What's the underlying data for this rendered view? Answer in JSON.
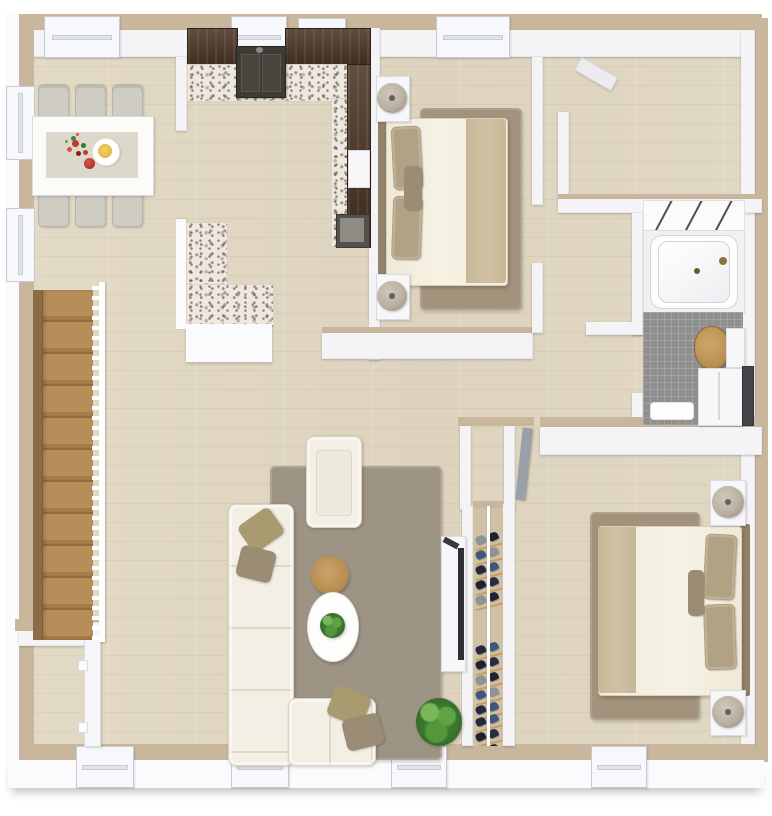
{
  "scene": {
    "type": "3d-floorplan-top-down-render",
    "description": "Two-bedroom apartment 3D floor plan viewed from above; no text labels are rendered in the image"
  },
  "colors": {
    "wall-top": "#c8b69d",
    "wall-face": "#f4f4f7",
    "floor": "#e0d7c2",
    "espresso": "#4b3424",
    "granite-base": "#eee8df",
    "sink": "#3f3a34",
    "rug-bed": "#a3927c",
    "rug-living": "#9e9485",
    "cream": "#f3efe4",
    "cream-border": "#d9d3c0",
    "pillow-olive": "#a99b70",
    "pillow-taupe": "#9b8c76",
    "pillow-tan": "#b2a284",
    "blanket": "#d0c1a4",
    "headboard": "#93826a",
    "wood": "#b98f52",
    "stair-wood": "#b38d58",
    "bath-floor": "#8f8f8f",
    "toilet-wood": "#ba9052",
    "green": "#4d8c38",
    "green-dark": "#336b26",
    "lamp": "#b9afa1",
    "lamp-dark": "#685f54",
    "door-gray": "#9aa0a8",
    "chair": "#cfccc3",
    "runner": "#dcd8cb",
    "tv": "#2e2f33"
  },
  "rooms": [
    {
      "name": "dining-area",
      "items": [
        "dining-table",
        "table-runner",
        "flower-centerpiece",
        "serving-plate",
        "apple",
        "six-dining-chairs"
      ]
    },
    {
      "name": "kitchen",
      "items": [
        "espresso-upper-cabinets",
        "granite-counter",
        "double-basin-sink",
        "refrigerator",
        "stove",
        "l-shaped-granite-peninsula"
      ]
    },
    {
      "name": "bedroom-1",
      "items": [
        "double-bed",
        "headboard",
        "pillows",
        "throw-blanket",
        "area-rug",
        "two-nightstands",
        "two-table-lamps"
      ]
    },
    {
      "name": "den",
      "items": [
        "open-door"
      ]
    },
    {
      "name": "bathroom",
      "items": [
        "bathtub",
        "tile-wall",
        "mosaic-floor",
        "wood-seat-toilet",
        "vanity",
        "bath-mat"
      ]
    },
    {
      "name": "living-room",
      "items": [
        "l-sectional-sofa",
        "throw-pillows",
        "armchair",
        "round-wood-coffee-table",
        "oval-side-table",
        "potted-plant",
        "tv-console",
        "tv",
        "large-plant",
        "area-rug"
      ]
    },
    {
      "name": "closet",
      "items": [
        "shoe-shelves",
        "hanging-rod"
      ]
    },
    {
      "name": "bedroom-2",
      "items": [
        "double-bed",
        "headboard",
        "pillows",
        "throw-blanket",
        "area-rug",
        "two-nightstands",
        "two-table-lamps",
        "open-door"
      ]
    },
    {
      "name": "staircase",
      "items": [
        "wood-treads",
        "baluster-railing",
        "stringer"
      ]
    },
    {
      "name": "entry-closet",
      "items": [
        "door"
      ]
    }
  ],
  "closet": {
    "shelf_groups": [
      {
        "offset": 26,
        "count": 5
      },
      {
        "offset": 136,
        "count": 5
      },
      {
        "offset": 208,
        "count": 3
      }
    ],
    "shoe_colors": [
      "#252a3e",
      "#41567c",
      "#8d929c",
      "#1e2230"
    ]
  },
  "stairs": {
    "tread_count": 12
  },
  "windows": {
    "top_wall": 4,
    "bottom_wall": 4,
    "left_wall": 2
  }
}
